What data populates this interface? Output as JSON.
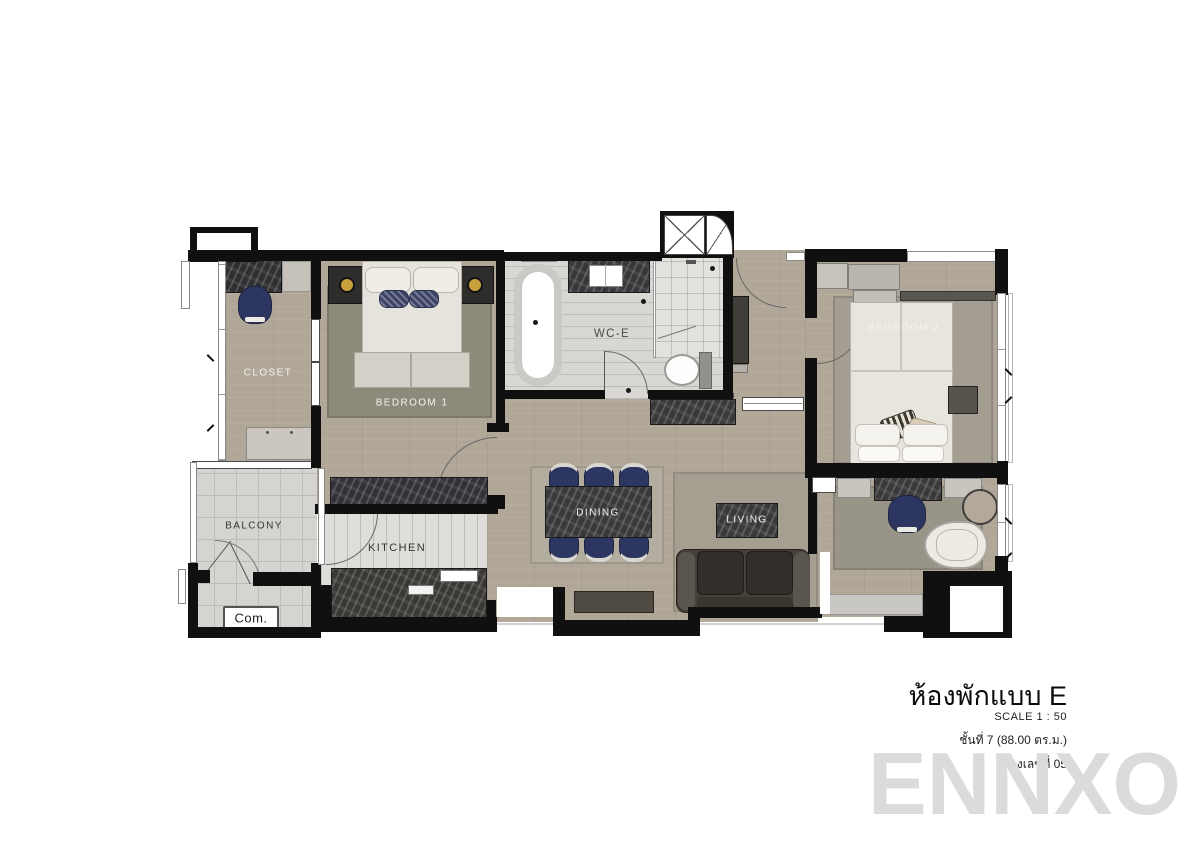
{
  "floor_plan": {
    "rooms": {
      "closet": {
        "label": "CLOSET"
      },
      "bedroom1": {
        "label": "BEDROOM 1"
      },
      "wc": {
        "label": "WC-E"
      },
      "bedroom2": {
        "label": "BEDROOM 2"
      },
      "balcony": {
        "label": "BALCONY"
      },
      "kitchen": {
        "label": "KITCHEN"
      },
      "dining": {
        "label": "DINING"
      },
      "living": {
        "label": "LIVING"
      }
    },
    "annotations": {
      "compressor_label": "Com."
    }
  },
  "title_block": {
    "unit_type": "ห้องพักแบบ E",
    "scale": "SCALE 1 : 50",
    "floor_info": "ชั้นที่ 7 (88.00 ตร.ม.)",
    "room_info": "ห้องเลขที่ 05"
  },
  "watermark": "ENNXO",
  "colors": {
    "wall": "#101010",
    "wood_floor": "#b1a798",
    "bath_tile": "#d8d7d4",
    "balcony_tile": "#d5d4d1",
    "dark_marble": "#39383a",
    "navy_chair": "#2c3660",
    "sofa": "#45403a",
    "rug_bedroom1": "#8e8a7b",
    "rug_living": "#a59f92",
    "watermark_gray": "#dbdbdb"
  }
}
